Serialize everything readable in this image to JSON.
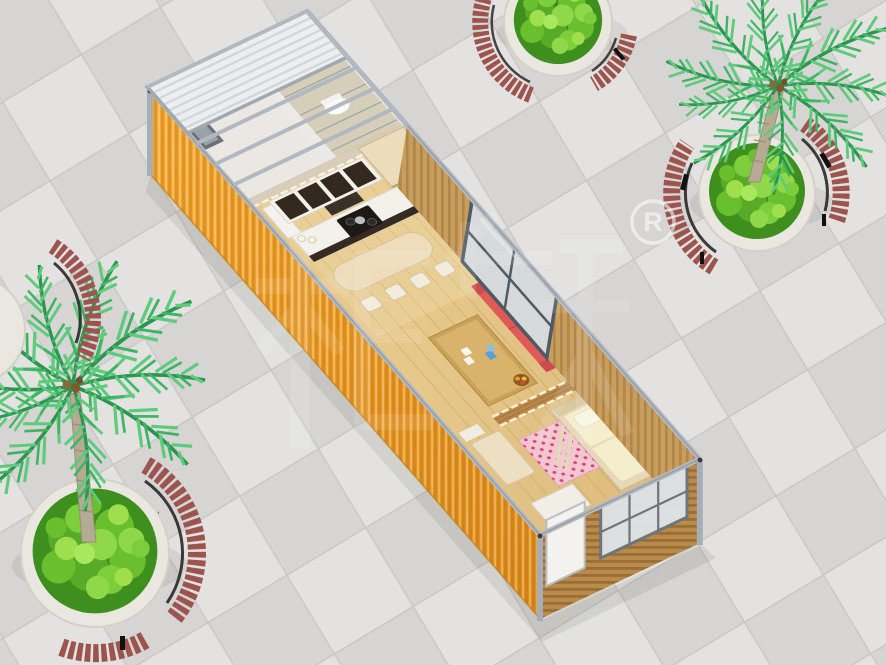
{
  "watermark": {
    "brand_characters": "柜族",
    "registered_symbol": "R"
  },
  "colors": {
    "tile_light": "#e3e2e0",
    "tile_dark": "#d6d5d3",
    "tile_seam": "#c9c8c6",
    "metal_frame": "#b4bac2",
    "metal_dark": "#8f959d",
    "container_orange": "#f6a92f",
    "container_orange_deep": "#e08f1d",
    "interior_wood_wall": "#c99e5d",
    "wood_floor_light": "#e6c88b",
    "wood_floor_dark": "#d2ac6a",
    "end_wall_wood": "#b98a49",
    "partition_wood": "#b9894c",
    "cabinet_dark": "#34291f",
    "counter_white": "#f3f1ea",
    "bar_wood": "#eedcba",
    "sofa_red": "#e05a5a",
    "sofa_red_dark": "#c94b4b",
    "bed_frame": "#e7d9b8",
    "mattress_cream": "#f4eecd",
    "pillow_white": "#faf6e3",
    "rug_pink": "#f2c6d2",
    "rug_dot": "#d6486e",
    "bathroom_white": "#ebe8e3",
    "shower_glass": "#cdd6da",
    "glass_pane": "#d8dee2",
    "window_frame": "#4f5a64",
    "door_white": "#f3f2ef",
    "bench_wood": "#9c544e",
    "bench_metal": "#1d1d1d",
    "planter_stone": "#eae7e1",
    "soil_dark": "#463823",
    "bush_green": "#6abf2e",
    "palm_frond": "#2e9452",
    "palm_trunk": "#b5aa92",
    "glow_strip": "#fff6dc",
    "watermark_white": "#ffffff"
  }
}
